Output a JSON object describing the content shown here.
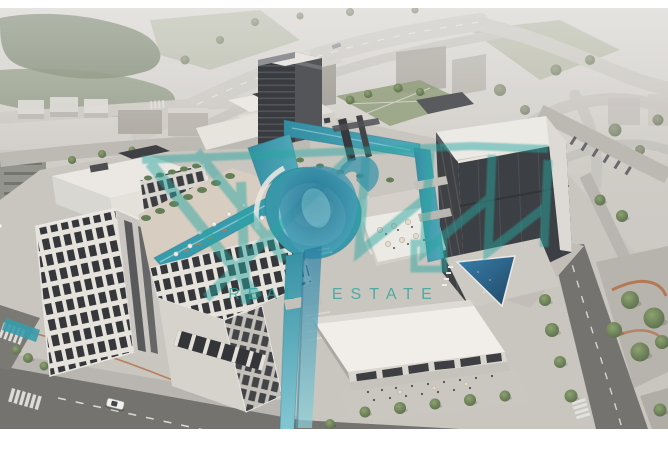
{
  "image": {
    "kind": "aerial-architectural-rendering",
    "subject": "Mixed-use real estate development with winding canal, rooftop pools, offices and retail pavilion",
    "frame": {
      "width": 668,
      "height": 452,
      "photo_top": 8,
      "photo_bottom": 429
    }
  },
  "watermark": {
    "tagline": "REAL ESTATE",
    "logo": "teal-calligraphic-monogram",
    "color": "#2FA39C"
  },
  "palette": {
    "haze": "#D5D3CD",
    "building_white": "#ECEAE5",
    "facade_dark": "#33363A",
    "water_teal": "#2F95A8",
    "water_light": "#9FD3DD",
    "pool_deep_blue": "#2A6D9C",
    "greenery": "#6E7F5E",
    "road_dark": "#6E6E6A",
    "road_light": "#C6C4BE",
    "path_accent_terracotta": "#B2693D",
    "deck_sand": "#D6CDBF"
  },
  "scene": {
    "regions": [
      {
        "name": "background-highway",
        "label": "Curving highway and hazy greenbelt"
      },
      {
        "name": "dark-tower",
        "label": "Dark high-rise tower"
      },
      {
        "name": "left-building-cluster",
        "label": "Mid-rise blocks with rooftop pool deck"
      },
      {
        "name": "right-office-building",
        "label": "Office building with white cantilevered roof"
      },
      {
        "name": "retail-pavilion",
        "label": "Retail pavilion with terrace seating"
      },
      {
        "name": "central-canal",
        "label": "Winding turquoise canal and lagoon"
      },
      {
        "name": "street-scene",
        "label": "Perimeter streets, crosswalks and car"
      }
    ]
  }
}
